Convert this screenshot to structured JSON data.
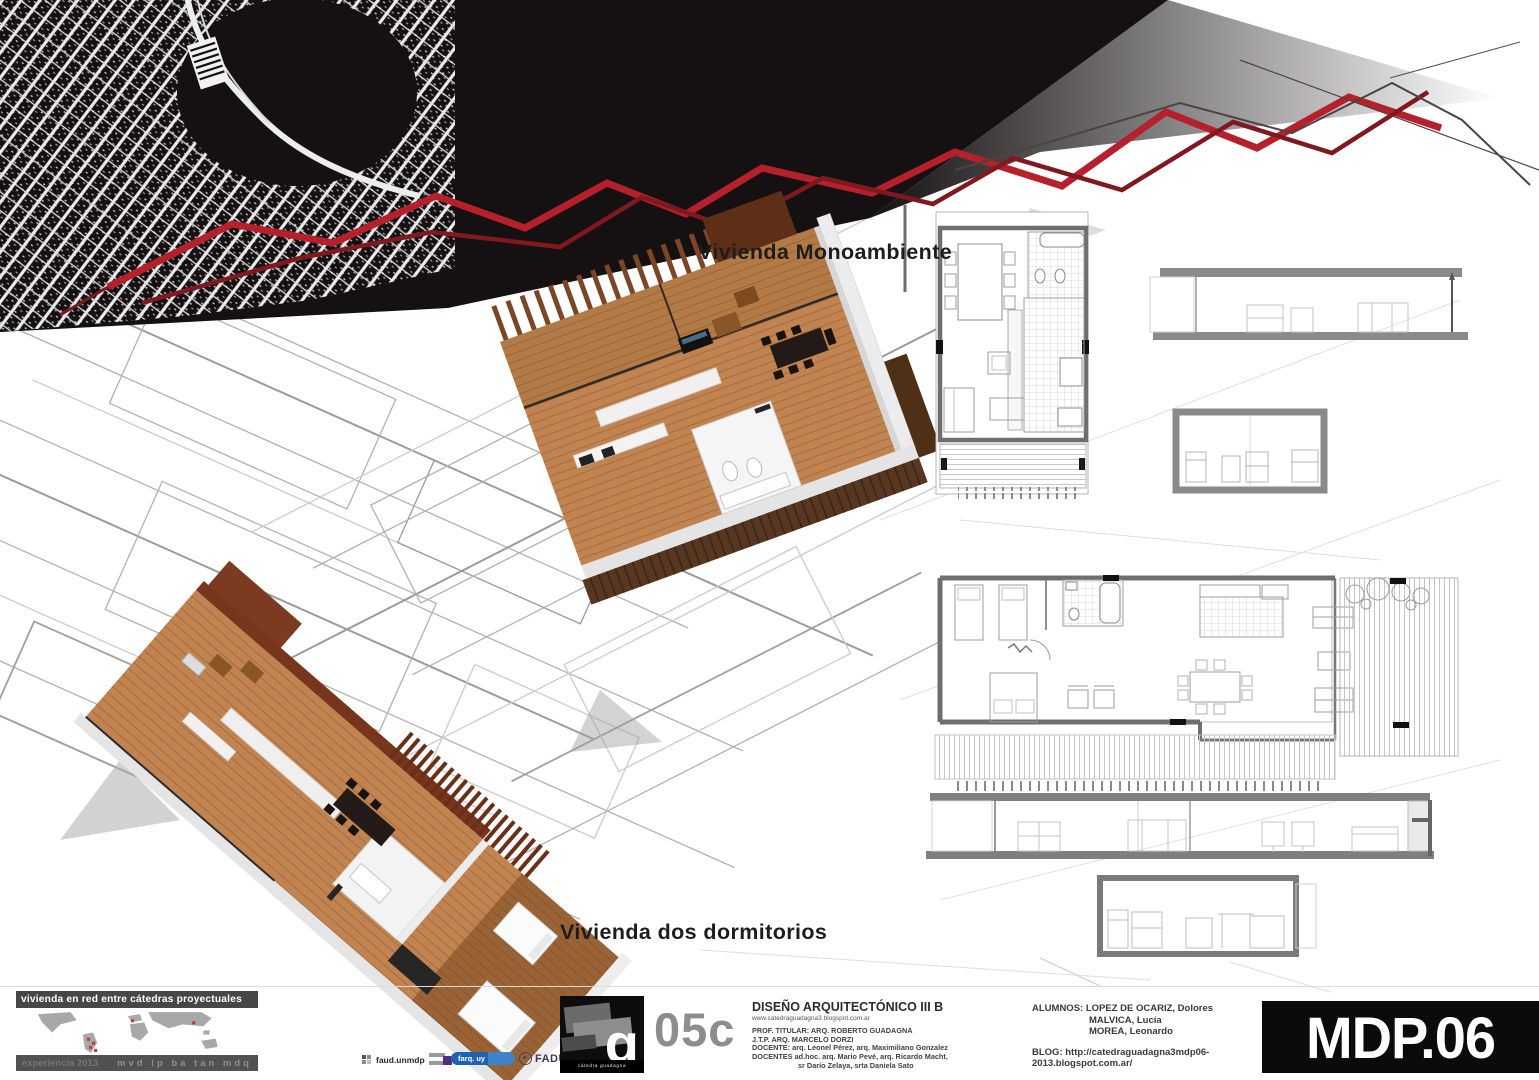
{
  "renders": {
    "unit1_label": "Vivienda Monoambiente",
    "unit2_label": "Vivienda dos dormitorios"
  },
  "footer": {
    "network": {
      "title": "vivienda en red entre cátedras proyectuales",
      "era": "experiencia 2013",
      "cities": "mvd lp ba tan mdq"
    },
    "logos": {
      "faud": "faud.unmdp",
      "farq": "farq. uy",
      "fadu": "FADU",
      "fadu_note": "arquitectura",
      "g_mark": "g",
      "g_caption": "cátedra guadagna"
    },
    "sheet_code": "05c",
    "course": {
      "title": "DISEÑO ARQUITECTÓNICO III B",
      "url": "www.catedraguadagna3.blogspot.com.ar",
      "prof": "PROF. TITULAR: ARQ. ROBERTO GUADAGNA",
      "jtp": "J.T.P. ARQ. MARCELO DORZI",
      "docente": "DOCENTE: arq. Leonel Pérez, arq. Maximiliano Gonzalez",
      "docentes_adhoc": "DOCENTES ad.hoc. arq. Mario Pevé, arq. Ricardo Macht,",
      "docentes_adhoc2": "sr Darío Zelaya, srta Daniela Sato"
    },
    "students": {
      "line1": "ALUMNOS: LOPEZ DE OCARIZ, Dolores",
      "line2": "MALVICA, Lucía",
      "line3": "MOREA, Leonardo",
      "blog": "BLOG: http://catedraguadagna3mdp06-2013.blogspot.com.ar/"
    },
    "plate_code": "MDP.06"
  },
  "colors": {
    "banner_black": "#151011",
    "accent_red": "#b5202a",
    "accent_red_dark": "#801820",
    "wood_floor": "#c1834f",
    "deck_brown": "#573721",
    "slat_brown": "#7b4526",
    "red_wall": "#7c3a20",
    "plan_wall_gray": "#6e6e6e",
    "farq_blue": "#1f63b0",
    "map_dot_red": "#c0392b",
    "plate_bg": "#0b0b0b",
    "sheet_code_gray": "#8d8d8d"
  }
}
